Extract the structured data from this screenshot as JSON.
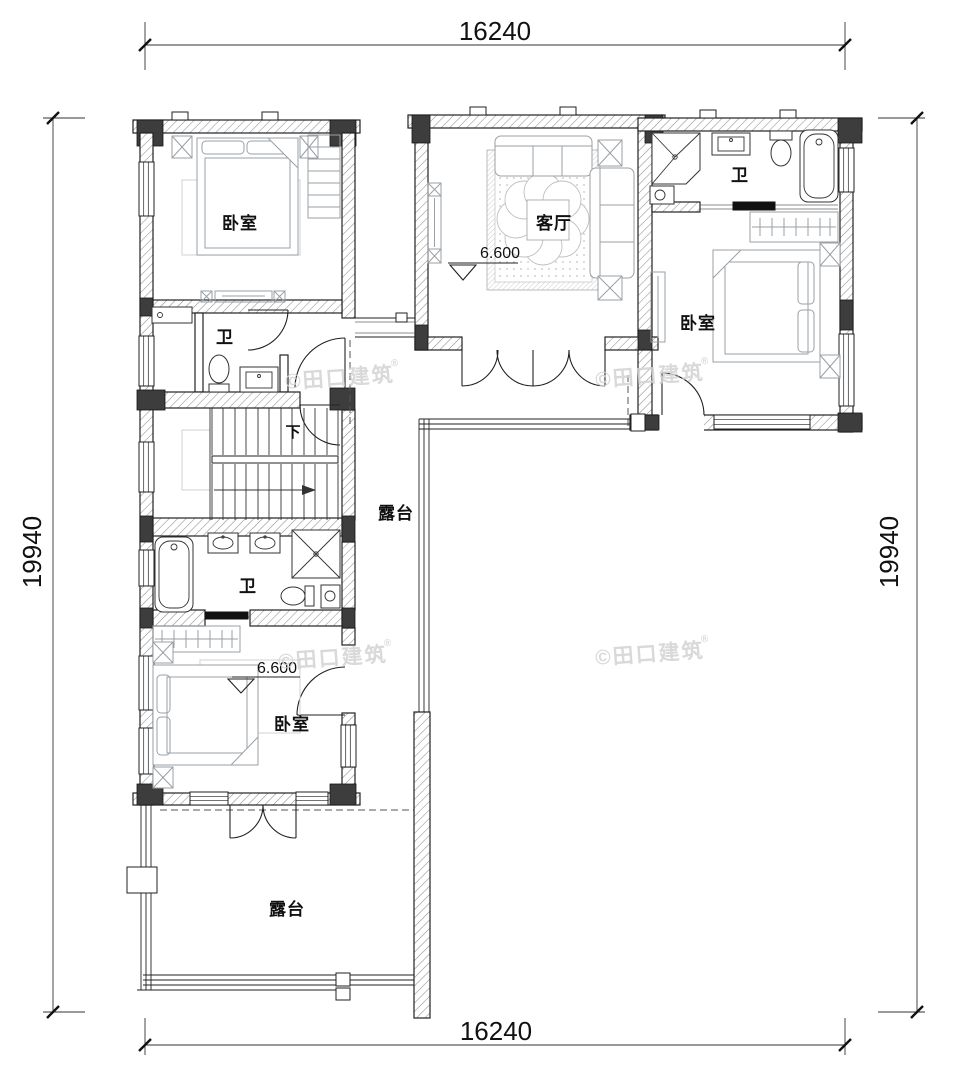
{
  "dimensions": {
    "top": "16240",
    "bottom": "16240",
    "left": "19940",
    "right": "19940"
  },
  "rooms": {
    "bedroom_top_left": "卧室",
    "bath_top_left": "卫",
    "living_room": "客厅",
    "bath_right": "卫",
    "bedroom_right": "卧室",
    "bath_middle": "卫",
    "bedroom_bottom_left": "卧室",
    "terrace_middle": "露台",
    "terrace_bottom": "露台"
  },
  "annotations": {
    "stair_down": "下",
    "elevation_living": "6.600",
    "elevation_bedroom": "6.600"
  },
  "watermark": {
    "text": "©田口建筑",
    "reg": "®"
  }
}
